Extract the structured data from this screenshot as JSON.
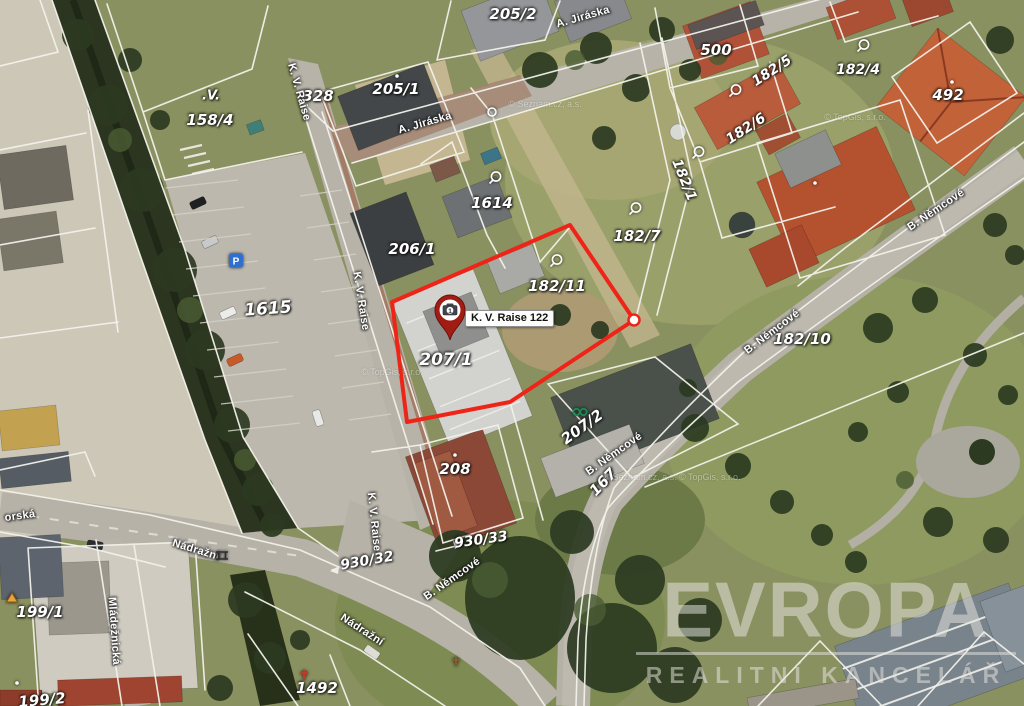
{
  "map": {
    "marker": {
      "x": 450,
      "y": 342,
      "label": "K. V. Raise 122",
      "photo_count": "1"
    },
    "highlight": {
      "points": "392,302 570,225 634,320 510,402 407,422",
      "vertex_x": 634,
      "vertex_y": 320,
      "color": "#ee2418"
    },
    "parcel_labels": [
      {
        "text": "205/2",
        "x": 513,
        "y": 14,
        "rot": 0
      },
      {
        "text": "205/1",
        "x": 396,
        "y": 89,
        "rot": 0
      },
      {
        "text": "500",
        "x": 716,
        "y": 50,
        "rot": 0
      },
      {
        "text": "182/5",
        "x": 772,
        "y": 71,
        "rot": -33,
        "fs": 14
      },
      {
        "text": "182/4",
        "x": 858,
        "y": 70,
        "rot": 0,
        "fs": 14
      },
      {
        "text": "492",
        "x": 948,
        "y": 95,
        "rot": 0
      },
      {
        "text": "182/6",
        "x": 746,
        "y": 129,
        "rot": -33,
        "fs": 14
      },
      {
        "text": ".V.",
        "x": 211,
        "y": 96,
        "rot": 0,
        "fs": 13
      },
      {
        "text": "158/4",
        "x": 210,
        "y": 120,
        "rot": 0
      },
      {
        "text": "328",
        "x": 318,
        "y": 96,
        "rot": 0
      },
      {
        "text": "1614",
        "x": 492,
        "y": 203,
        "rot": 0
      },
      {
        "text": "206/1",
        "x": 412,
        "y": 249,
        "rot": 0
      },
      {
        "text": "182/7",
        "x": 637,
        "y": 236,
        "rot": 0
      },
      {
        "text": "182/11",
        "x": 557,
        "y": 286,
        "rot": 0
      },
      {
        "text": "182/1",
        "x": 684,
        "y": 180,
        "rot": 68,
        "fs": 14
      },
      {
        "text": "1615",
        "x": 268,
        "y": 309,
        "rot": -4,
        "fs": 17
      },
      {
        "text": "182/10",
        "x": 802,
        "y": 339,
        "rot": 0
      },
      {
        "text": "207/1",
        "x": 446,
        "y": 360,
        "rot": 0,
        "fs": 17
      },
      {
        "text": "207/2",
        "x": 582,
        "y": 427,
        "rot": -36
      },
      {
        "text": "208",
        "x": 455,
        "y": 469,
        "rot": 0
      },
      {
        "text": "167",
        "x": 603,
        "y": 482,
        "rot": -46
      },
      {
        "text": "930/33",
        "x": 481,
        "y": 540,
        "rot": -8,
        "fs": 14
      },
      {
        "text": "930/32",
        "x": 367,
        "y": 561,
        "rot": -10,
        "fs": 14
      },
      {
        "text": "199/1",
        "x": 40,
        "y": 612,
        "rot": 0
      },
      {
        "text": "199/2",
        "x": 42,
        "y": 700,
        "rot": -5
      },
      {
        "text": "1492",
        "x": 317,
        "y": 688,
        "rot": 0
      }
    ],
    "street_labels": [
      {
        "text": "A. Jiráska",
        "x": 583,
        "y": 17,
        "rot": -16
      },
      {
        "text": "A. Jiráska",
        "x": 425,
        "y": 123,
        "rot": -16
      },
      {
        "text": "K. V. Raise",
        "x": 299,
        "y": 92,
        "rot": 74
      },
      {
        "text": "K. V. Raise",
        "x": 361,
        "y": 301,
        "rot": 81
      },
      {
        "text": "K. V. Raise",
        "x": 374,
        "y": 522,
        "rot": 84
      },
      {
        "text": "B. Němcové",
        "x": 936,
        "y": 210,
        "rot": -34
      },
      {
        "text": "B. Němcové",
        "x": 772,
        "y": 332,
        "rot": -37
      },
      {
        "text": "B. Němcové",
        "x": 614,
        "y": 454,
        "rot": -35
      },
      {
        "text": "B. Němcové",
        "x": 452,
        "y": 579,
        "rot": -35
      },
      {
        "text": "Nádražní",
        "x": 196,
        "y": 550,
        "rot": 17
      },
      {
        "text": "Nádražní",
        "x": 362,
        "y": 630,
        "rot": 33
      },
      {
        "text": "Mládežnická",
        "x": 114,
        "y": 631,
        "rot": 86
      },
      {
        "text": "orská",
        "x": 20,
        "y": 516,
        "rot": -8
      }
    ],
    "copyright_labels": [
      {
        "text": "© Seznam.cz, a.s.",
        "x": 545,
        "y": 104,
        "rot": 0
      },
      {
        "text": "© TopGis, s.r.o.",
        "x": 855,
        "y": 117,
        "rot": 0
      },
      {
        "text": "© Seznam.cz, a.s. © TopGis, s.r.o.",
        "x": 672,
        "y": 477,
        "rot": 0
      },
      {
        "text": "© TopGis, s.r.o.",
        "x": 392,
        "y": 372,
        "rot": 0
      }
    ],
    "symbols": [
      {
        "type": "qwell",
        "x": 495,
        "y": 181
      },
      {
        "type": "qwell",
        "x": 635,
        "y": 212
      },
      {
        "type": "qwell",
        "x": 556,
        "y": 264
      },
      {
        "type": "qwell",
        "x": 735,
        "y": 94
      },
      {
        "type": "qwell",
        "x": 698,
        "y": 156
      },
      {
        "type": "qwell",
        "x": 863,
        "y": 49
      },
      {
        "type": "node",
        "x": 492,
        "y": 114
      },
      {
        "type": "glink",
        "x": 580,
        "y": 413
      },
      {
        "type": "parking",
        "x": 236,
        "y": 263
      },
      {
        "type": "triangle",
        "x": 12,
        "y": 599
      },
      {
        "type": "monument",
        "x": 304,
        "y": 677
      },
      {
        "type": "cross",
        "x": 456,
        "y": 663
      },
      {
        "type": "bridge",
        "x": 222,
        "y": 557
      },
      {
        "type": "dot",
        "x": 397,
        "y": 75
      },
      {
        "type": "dot",
        "x": 952,
        "y": 81
      },
      {
        "type": "dot",
        "x": 815,
        "y": 182
      },
      {
        "type": "dot",
        "x": 455,
        "y": 454
      },
      {
        "type": "dot",
        "x": 17,
        "y": 682
      }
    ]
  },
  "watermark": {
    "brand": "EVROPA",
    "tagline": "REALITNÍ KANCELÁŘ"
  }
}
